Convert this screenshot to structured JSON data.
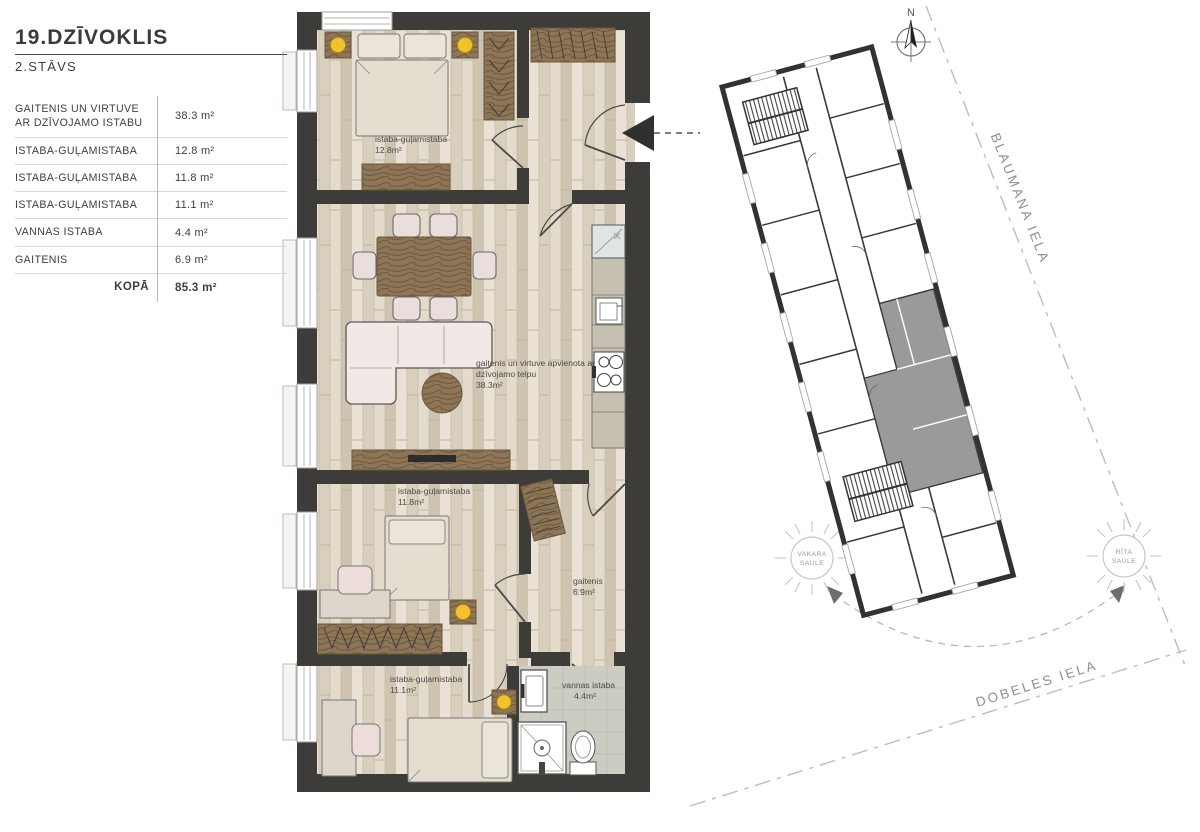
{
  "legend": {
    "title": "19.DZĪVOKLIS",
    "subtitle": "2.STĀVS",
    "rows": [
      {
        "label": "GAITENIS UN VIRTUVE AR DZĪVOJAMO ISTABU",
        "value": "38.3 m²"
      },
      {
        "label": "ISTABA-GUĻAMISTABA",
        "value": "12.8 m²"
      },
      {
        "label": "ISTABA-GUĻAMISTABA",
        "value": "11.8 m²"
      },
      {
        "label": "ISTABA-GUĻAMISTABA",
        "value": "11.1 m²"
      },
      {
        "label": "VANNAS ISTABA",
        "value": "4.4 m²"
      },
      {
        "label": "GAITENIS",
        "value": "6.9 m²"
      }
    ],
    "total_label": "KOPĀ",
    "total_value": "85.3 m²"
  },
  "floorplan": {
    "rooms": [
      {
        "name": "istaba-guļamistaba",
        "area": "12.8m²"
      },
      {
        "name_line1": "gaitenis un virtuve apvienota ar",
        "name_line2": "dzīvojamo telpu",
        "area": "38.3m²"
      },
      {
        "name": "istaba-guļamistaba",
        "area": "11.8m²"
      },
      {
        "name": "gaitenis",
        "area": "6.9m²"
      },
      {
        "name": "istaba-guļamistaba",
        "area": "11.1m²"
      },
      {
        "name": "vannas istaba",
        "area": "4.4m²"
      }
    ]
  },
  "siteplan": {
    "compass": "N",
    "streets": [
      {
        "name": "BLAUMANA IELA"
      },
      {
        "name": "DOBELES IELA"
      }
    ],
    "suns": [
      {
        "line1": "VAKARA",
        "line2": "SAULE"
      },
      {
        "line1": "RĪTA",
        "line2": "SAULE"
      }
    ]
  },
  "colors": {
    "wall": "#3e3c39",
    "lamp_accent": "#f2c12e",
    "unit_highlight": "#9a9a9a",
    "wood_furniture": "#8d7556"
  }
}
